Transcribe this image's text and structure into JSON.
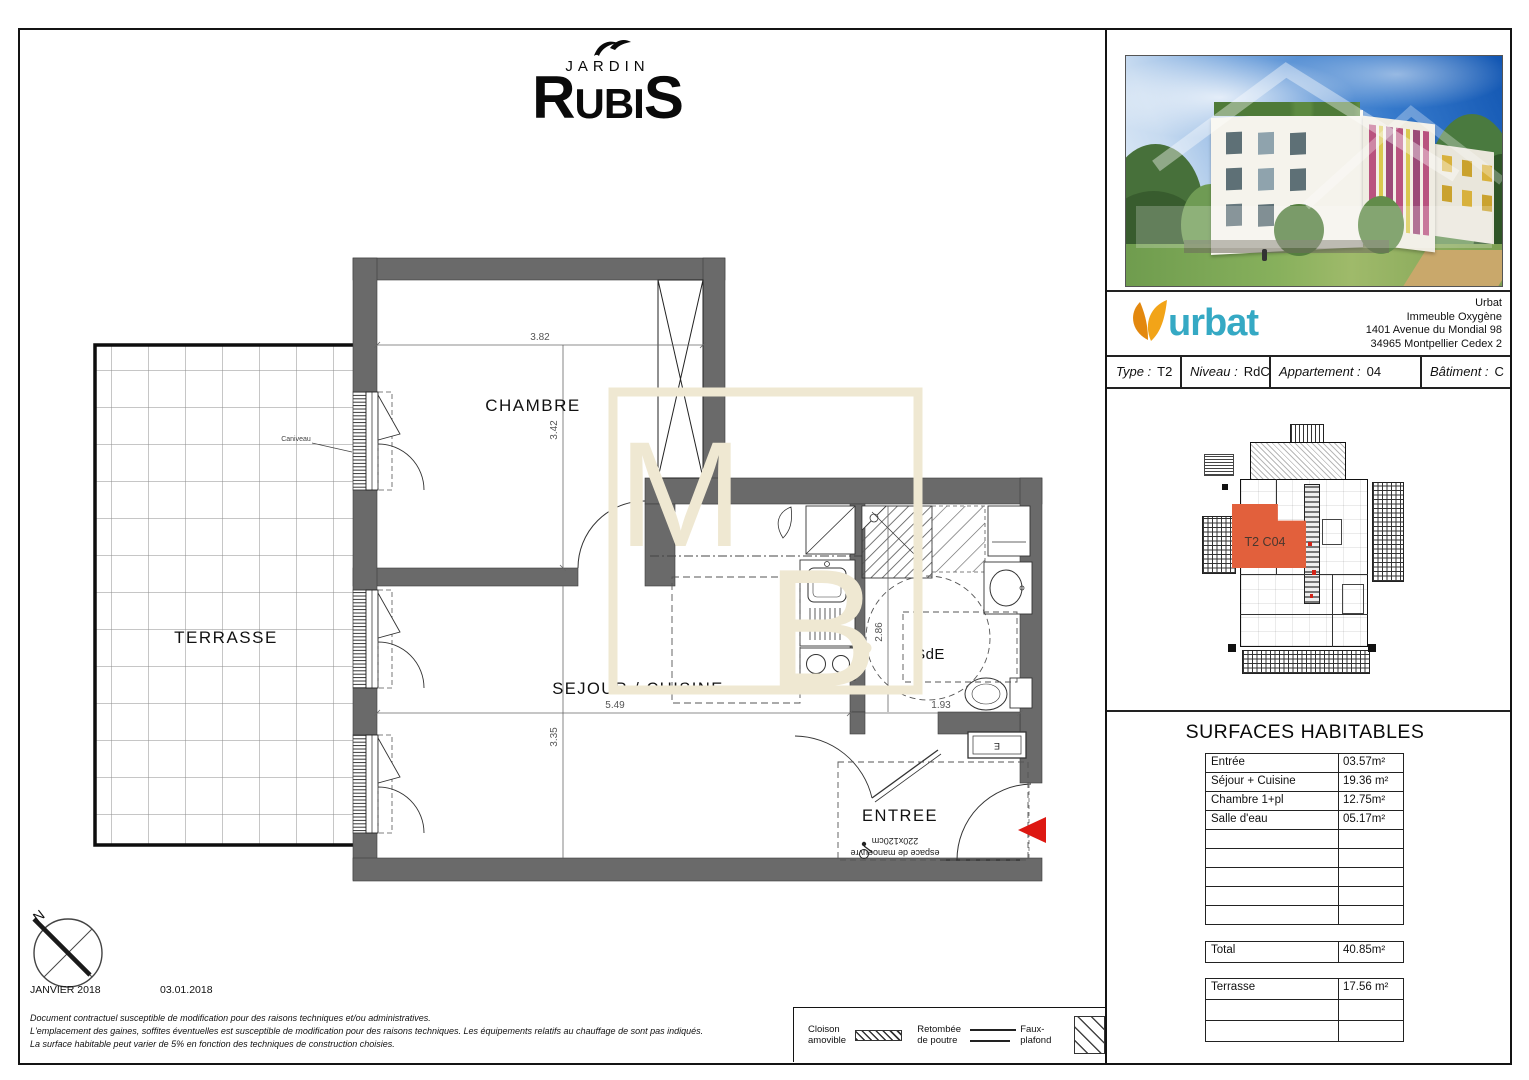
{
  "brand": {
    "word_top": "JARDIN",
    "r": "R",
    "ubi": "UBI",
    "s": "S"
  },
  "rooms": {
    "terrasse": "TERRASSE",
    "chambre": "CHAMBRE",
    "sejour": "SEJOUR / CUISINE",
    "sde": "SdE",
    "entree": "ENTREE"
  },
  "dims": {
    "chambre_w": "3.82",
    "chambre_h": "3.42",
    "sejour_w": "5.49",
    "sejour_h": "3.35",
    "sde_h": "2.86",
    "sde_w": "1.93"
  },
  "annotations": {
    "caniveau": "Caniveau",
    "manoeuvre_line1": "espace de manoeuvre",
    "manoeuvre_line2": "220x120cm",
    "elec": "E",
    "north": "N"
  },
  "footer": {
    "month": "JANVIER 2018",
    "date": "03.01.2018",
    "legal": [
      "Document contractuel susceptible de modification pour des raisons techniques et/ou administratives.",
      "L'emplacement des gaines, soffites éventuelles est susceptible de modification pour des raisons techniques. Les équipements relatifs au chauffage de sont pas indiqués.",
      "La surface habitable peut varier de 5% en fonction des techniques de construction choisies."
    ]
  },
  "legend": {
    "cloison_l1": "Cloison",
    "cloison_l2": "amovible",
    "retombee_l1": "Retombée",
    "retombee_l2": "de poutre",
    "faux": "Faux-plafond"
  },
  "company": {
    "name": "urbat",
    "address": [
      "Urbat",
      "Immeuble Oxygène",
      "1401 Avenue du Mondial 98",
      "34965 Montpellier Cedex 2"
    ]
  },
  "info": {
    "cells": [
      {
        "label": "Type :",
        "value": "T2"
      },
      {
        "label": "Niveau :",
        "value": "RdC"
      },
      {
        "label": "Appartement :",
        "value": "04"
      },
      {
        "label": "Bâtiment :",
        "value": "C"
      }
    ]
  },
  "keyplan": {
    "unit": "T2 C04"
  },
  "surfaces": {
    "title": "SURFACES HABITABLES",
    "rows": [
      {
        "label": "Entrée",
        "value": "03.57m²"
      },
      {
        "label": "Séjour + Cuisine",
        "value": "19.36 m²"
      },
      {
        "label": "Chambre 1+pl",
        "value": "12.75m²"
      },
      {
        "label": "Salle d'eau",
        "value": "05.17m²"
      },
      {
        "label": "",
        "value": ""
      },
      {
        "label": "",
        "value": ""
      },
      {
        "label": "",
        "value": ""
      },
      {
        "label": "",
        "value": ""
      },
      {
        "label": "",
        "value": ""
      }
    ],
    "total": {
      "label": "Total",
      "value": "40.85m²"
    },
    "terrasse_rows": [
      {
        "label": "Terrasse",
        "value": "17.56 m²"
      },
      {
        "label": "",
        "value": ""
      },
      {
        "label": "",
        "value": ""
      }
    ]
  },
  "colors": {
    "accent_orange": "#e2603c",
    "urbat_teal": "#35a9c4",
    "urbat_orange": "#f2a418",
    "arrow_red": "#dd1812",
    "watermark_cream": "#efe8d2",
    "wall_gray": "#6a6a6a"
  }
}
